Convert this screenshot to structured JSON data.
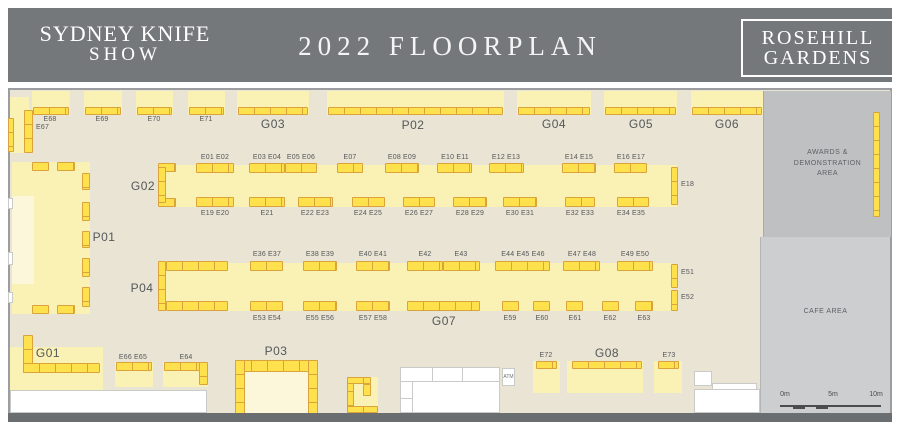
{
  "header": {
    "logo_line1": "SYDNEY KNIFE",
    "logo_line2": "SHOW",
    "title": "2022 FLOORPLAN",
    "venue_line1": "ROSEHILL",
    "venue_line2": "GARDENS"
  },
  "colors": {
    "header_bg": "#75787B",
    "floor": "#E9E4D3",
    "island": "#FAF1B4",
    "island_pale": "#FCF7DB",
    "stand_fill": "#FFE14E",
    "stand_border": "#D9A43C",
    "awards_bg": "#BEC0C2",
    "cafe_bg": "#CCCED0",
    "wall": "#9B9DA0",
    "wall_dark": "#6B6E71",
    "label_text": "#55575A"
  },
  "areas": {
    "awards": {
      "label_lines": [
        "AWARDS &",
        "DEMONSTRATION",
        "AREA"
      ]
    },
    "cafe": {
      "label": "CAFE AREA"
    },
    "atm": {
      "label": "ATM"
    }
  },
  "scale_bar": {
    "labels": [
      "0m",
      "5m",
      "10m"
    ]
  },
  "islands": [
    [
      10,
      97,
      19,
      56
    ],
    [
      32,
      91,
      38,
      24
    ],
    [
      84,
      91,
      38,
      24
    ],
    [
      136,
      91,
      37,
      24
    ],
    [
      188,
      91,
      37,
      24
    ],
    [
      237,
      91,
      72,
      24
    ],
    [
      327,
      91,
      177,
      24
    ],
    [
      517,
      91,
      74,
      24
    ],
    [
      604,
      91,
      73,
      24
    ],
    [
      691,
      91,
      72,
      24
    ],
    [
      158,
      165,
      519,
      42
    ],
    [
      158,
      263,
      514,
      48
    ],
    [
      12,
      162,
      78,
      152
    ],
    [
      10,
      347,
      93,
      43
    ],
    [
      115,
      362,
      38,
      25
    ],
    [
      163,
      362,
      45,
      25
    ],
    [
      533,
      361,
      27,
      32
    ],
    [
      567,
      361,
      76,
      32
    ],
    [
      654,
      361,
      28,
      32
    ],
    [
      347,
      377,
      31,
      36
    ]
  ],
  "pale_rects": [
    [
      12,
      196,
      22,
      88
    ],
    [
      245,
      372,
      63,
      41
    ]
  ],
  "stands": [
    [
      33,
      107,
      36,
      8
    ],
    [
      85,
      107,
      36,
      8
    ],
    [
      137,
      107,
      35,
      8
    ],
    [
      189,
      107,
      35,
      8
    ],
    [
      238,
      107,
      70,
      8
    ],
    [
      328,
      107,
      175,
      8
    ],
    [
      518,
      107,
      72,
      8
    ],
    [
      605,
      107,
      71,
      8
    ],
    [
      692,
      107,
      70,
      8
    ],
    [
      24,
      110,
      9,
      43,
      1
    ],
    [
      8,
      118,
      6,
      34,
      1
    ],
    [
      158,
      163,
      18,
      9
    ],
    [
      158,
      198,
      18,
      9
    ],
    [
      158,
      167,
      8,
      36,
      1
    ],
    [
      196,
      163,
      38,
      10
    ],
    [
      249,
      163,
      36,
      10
    ],
    [
      285,
      163,
      32,
      10
    ],
    [
      337,
      163,
      26,
      10
    ],
    [
      385,
      163,
      34,
      10
    ],
    [
      437,
      163,
      35,
      10
    ],
    [
      489,
      163,
      35,
      10
    ],
    [
      562,
      163,
      34,
      10
    ],
    [
      614,
      163,
      33,
      10
    ],
    [
      671,
      167,
      7,
      38,
      1
    ],
    [
      196,
      197,
      38,
      10
    ],
    [
      249,
      197,
      36,
      10
    ],
    [
      298,
      197,
      35,
      10
    ],
    [
      352,
      197,
      33,
      10
    ],
    [
      403,
      197,
      32,
      10
    ],
    [
      453,
      197,
      34,
      10
    ],
    [
      503,
      197,
      34,
      10
    ],
    [
      565,
      197,
      30,
      10
    ],
    [
      617,
      197,
      32,
      10
    ],
    [
      158,
      261,
      8,
      50,
      1
    ],
    [
      166,
      261,
      62,
      10
    ],
    [
      166,
      301,
      62,
      10
    ],
    [
      250,
      261,
      33,
      10
    ],
    [
      303,
      261,
      34,
      10
    ],
    [
      356,
      261,
      34,
      10
    ],
    [
      407,
      261,
      36,
      10
    ],
    [
      443,
      261,
      37,
      10
    ],
    [
      495,
      261,
      55,
      10
    ],
    [
      563,
      261,
      37,
      10
    ],
    [
      617,
      261,
      36,
      10
    ],
    [
      671,
      264,
      7,
      24,
      1
    ],
    [
      671,
      290,
      7,
      21,
      1
    ],
    [
      250,
      301,
      33,
      10
    ],
    [
      303,
      301,
      34,
      10
    ],
    [
      356,
      301,
      34,
      10
    ],
    [
      407,
      301,
      73,
      10
    ],
    [
      502,
      301,
      17,
      10
    ],
    [
      533,
      301,
      17,
      10
    ],
    [
      566,
      301,
      17,
      10
    ],
    [
      602,
      301,
      17,
      10
    ],
    [
      635,
      301,
      18,
      10
    ],
    [
      32,
      162,
      17,
      9
    ],
    [
      57,
      162,
      18,
      9
    ],
    [
      32,
      305,
      17,
      9
    ],
    [
      57,
      305,
      18,
      9
    ],
    [
      82,
      173,
      8,
      17,
      1
    ],
    [
      82,
      202,
      8,
      19,
      1
    ],
    [
      82,
      231,
      8,
      17,
      1
    ],
    [
      82,
      258,
      8,
      19,
      1
    ],
    [
      82,
      287,
      8,
      20,
      1
    ],
    [
      23,
      335,
      10,
      38,
      1
    ],
    [
      23,
      363,
      77,
      10
    ],
    [
      116,
      362,
      36,
      9
    ],
    [
      164,
      362,
      37,
      9
    ],
    [
      199,
      362,
      9,
      23,
      1
    ],
    [
      235,
      360,
      83,
      12
    ],
    [
      235,
      360,
      10,
      57,
      1
    ],
    [
      308,
      360,
      10,
      57,
      1
    ],
    [
      347,
      377,
      7,
      36,
      1
    ],
    [
      347,
      406,
      31,
      7
    ],
    [
      347,
      377,
      24,
      7
    ],
    [
      363,
      384,
      8,
      12,
      1
    ],
    [
      536,
      361,
      21,
      8
    ],
    [
      572,
      361,
      70,
      8
    ],
    [
      658,
      361,
      21,
      8
    ],
    [
      873,
      112,
      7,
      105,
      1
    ]
  ],
  "labels": [
    {
      "t": "G03",
      "x": 273,
      "y": 117,
      "big": 1
    },
    {
      "t": "P02",
      "x": 413,
      "y": 118,
      "big": 1
    },
    {
      "t": "G04",
      "x": 554,
      "y": 117,
      "big": 1
    },
    {
      "t": "G05",
      "x": 641,
      "y": 117,
      "big": 1
    },
    {
      "t": "G06",
      "x": 727,
      "y": 117,
      "big": 1
    },
    {
      "t": "G02",
      "x": 143,
      "y": 179,
      "big": 1
    },
    {
      "t": "P01",
      "x": 104,
      "y": 230,
      "big": 1
    },
    {
      "t": "P04",
      "x": 142,
      "y": 281,
      "big": 1
    },
    {
      "t": "G07",
      "x": 444,
      "y": 314,
      "big": 1
    },
    {
      "t": "G01",
      "x": 48,
      "y": 346,
      "big": 1
    },
    {
      "t": "P03",
      "x": 276,
      "y": 344,
      "big": 1
    },
    {
      "t": "G08",
      "x": 607,
      "y": 346,
      "big": 1
    },
    {
      "t": "E68",
      "x": 50,
      "y": 116
    },
    {
      "t": "E69",
      "x": 102,
      "y": 116
    },
    {
      "t": "E70",
      "x": 154,
      "y": 116
    },
    {
      "t": "E71",
      "x": 206,
      "y": 116
    },
    {
      "t": "E67",
      "x": 36,
      "y": 124,
      "left": 1
    },
    {
      "t": "E01 E02",
      "x": 215,
      "y": 154
    },
    {
      "t": "E03 E04",
      "x": 267,
      "y": 154
    },
    {
      "t": "E05 E06",
      "x": 301,
      "y": 154
    },
    {
      "t": "E07",
      "x": 350,
      "y": 154
    },
    {
      "t": "E08 E09",
      "x": 402,
      "y": 154
    },
    {
      "t": "E10 E11",
      "x": 455,
      "y": 154
    },
    {
      "t": "E12 E13",
      "x": 506,
      "y": 154
    },
    {
      "t": "E14 E15",
      "x": 579,
      "y": 154
    },
    {
      "t": "E16 E17",
      "x": 631,
      "y": 154
    },
    {
      "t": "E18",
      "x": 681,
      "y": 181,
      "left": 1
    },
    {
      "t": "E19 E20",
      "x": 215,
      "y": 210
    },
    {
      "t": "E21",
      "x": 267,
      "y": 210
    },
    {
      "t": "E22 E23",
      "x": 315,
      "y": 210
    },
    {
      "t": "E24 E25",
      "x": 368,
      "y": 210
    },
    {
      "t": "E26 E27",
      "x": 419,
      "y": 210
    },
    {
      "t": "E28 E29",
      "x": 470,
      "y": 210
    },
    {
      "t": "E30 E31",
      "x": 520,
      "y": 210
    },
    {
      "t": "E32 E33",
      "x": 580,
      "y": 210
    },
    {
      "t": "E34 E35",
      "x": 631,
      "y": 210
    },
    {
      "t": "E36 E37",
      "x": 267,
      "y": 251
    },
    {
      "t": "E38 E39",
      "x": 320,
      "y": 251
    },
    {
      "t": "E40 E41",
      "x": 373,
      "y": 251
    },
    {
      "t": "E42",
      "x": 425,
      "y": 251
    },
    {
      "t": "E43",
      "x": 461,
      "y": 251
    },
    {
      "t": "E44 E45 E46",
      "x": 523,
      "y": 251
    },
    {
      "t": "E47 E48",
      "x": 582,
      "y": 251
    },
    {
      "t": "E49 E50",
      "x": 635,
      "y": 251
    },
    {
      "t": "E51",
      "x": 681,
      "y": 269,
      "left": 1
    },
    {
      "t": "E52",
      "x": 681,
      "y": 294,
      "left": 1
    },
    {
      "t": "E53 E54",
      "x": 267,
      "y": 315
    },
    {
      "t": "E55 E56",
      "x": 320,
      "y": 315
    },
    {
      "t": "E57 E58",
      "x": 373,
      "y": 315
    },
    {
      "t": "E59",
      "x": 510,
      "y": 315
    },
    {
      "t": "E60",
      "x": 542,
      "y": 315
    },
    {
      "t": "E61",
      "x": 575,
      "y": 315
    },
    {
      "t": "E62",
      "x": 610,
      "y": 315
    },
    {
      "t": "E63",
      "x": 644,
      "y": 315
    },
    {
      "t": "E66 E65",
      "x": 133,
      "y": 354
    },
    {
      "t": "E64",
      "x": 186,
      "y": 354
    },
    {
      "t": "E72",
      "x": 546,
      "y": 352
    },
    {
      "t": "E73",
      "x": 669,
      "y": 352
    }
  ],
  "white_shapes": [
    [
      10,
      390,
      197,
      23
    ],
    [
      400,
      367,
      100,
      46
    ],
    [
      694,
      371,
      18,
      15
    ],
    [
      712,
      383,
      45,
      7
    ],
    [
      694,
      389,
      66,
      24
    ],
    [
      8,
      198,
      5,
      11
    ],
    [
      8,
      252,
      5,
      13
    ],
    [
      8,
      292,
      5,
      11
    ]
  ],
  "white_lines": [
    [
      400,
      381,
      100,
      1
    ],
    [
      432,
      367,
      1,
      14
    ],
    [
      462,
      367,
      1,
      14
    ],
    [
      412,
      381,
      1,
      32
    ],
    [
      400,
      398,
      12,
      1
    ]
  ]
}
